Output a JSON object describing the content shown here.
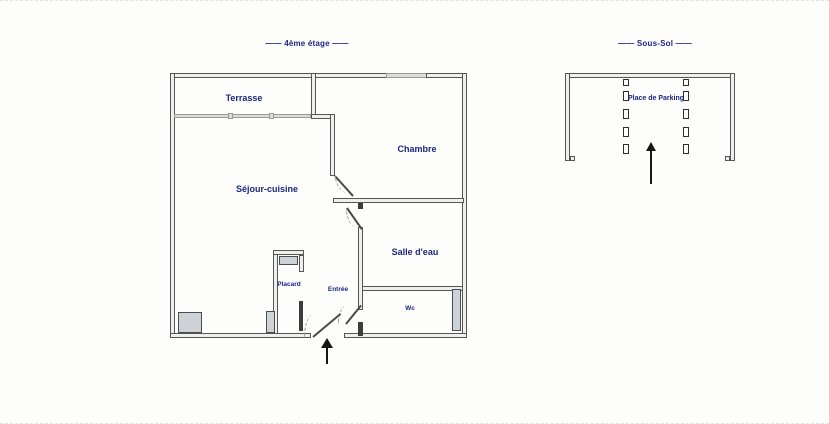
{
  "palette": {
    "label_text": "#1c2680",
    "wall_edge": "#565656",
    "wall_fill": "#eef0ef",
    "pillar_fill": "#cdd2d8",
    "window_fill": "#dcdcda",
    "arrow": "#161616",
    "background": "#fdfdfb"
  },
  "floor_plan": {
    "title": "—— 4ème étage ——",
    "rooms": {
      "terrasse": "Terrasse",
      "chambre": "Chambre",
      "sejour": "Séjour-cuisine",
      "salle_eau": "Salle d'eau",
      "placard": "Placard",
      "entree": "Entrée",
      "wc": "Wc"
    }
  },
  "parking_plan": {
    "title": "—— Sous-Sol ——",
    "space_label": "Place de Parking"
  }
}
